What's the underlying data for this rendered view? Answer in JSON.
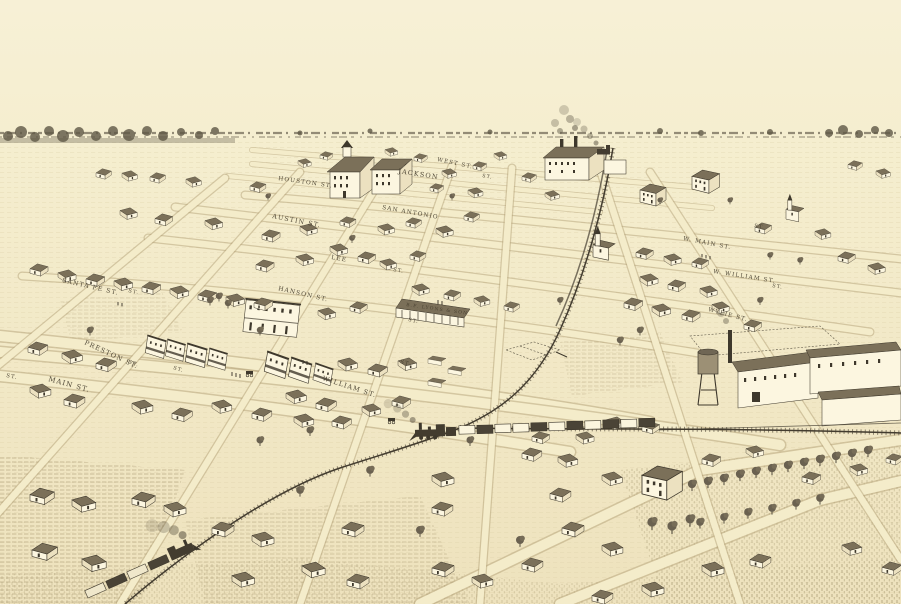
{
  "artwork": {
    "kind": "vintage bird's-eye view town lithograph",
    "palette": {
      "paper": "#f5eed1",
      "paper_shade": "#ece0ba",
      "ink": "#3e382c",
      "roof": "#7b7059",
      "road_fill": "#f4ecca",
      "road_edge": "#b3a177",
      "tree": "#6a6150"
    }
  },
  "streets": [
    {
      "id": "west",
      "label": "WEST ST."
    },
    {
      "id": "jackson",
      "label": "JACKSON"
    },
    {
      "id": "houston",
      "label": "HOUSTON ST."
    },
    {
      "id": "san-antonio",
      "label": "SAN ANTONIO"
    },
    {
      "id": "w-main",
      "label": "W. MAIN ST."
    },
    {
      "id": "austin",
      "label": "AUSTIN ST."
    },
    {
      "id": "w-william",
      "label": "W. WILLIAM ST."
    },
    {
      "id": "lee",
      "label": "LEE"
    },
    {
      "id": "wylie",
      "label": "WYLIE ST."
    },
    {
      "id": "santa-fe",
      "label": "SANTA FE ST."
    },
    {
      "id": "hanson",
      "label": "HANSON ST."
    },
    {
      "id": "preston",
      "label": "PRESTON ST."
    },
    {
      "id": "main",
      "label": "MAIN ST."
    },
    {
      "id": "william",
      "label": "WILLIAM ST."
    }
  ],
  "st_abbr": "ST.",
  "signs": {
    "lyons": "B.F. LYONS & SON"
  }
}
